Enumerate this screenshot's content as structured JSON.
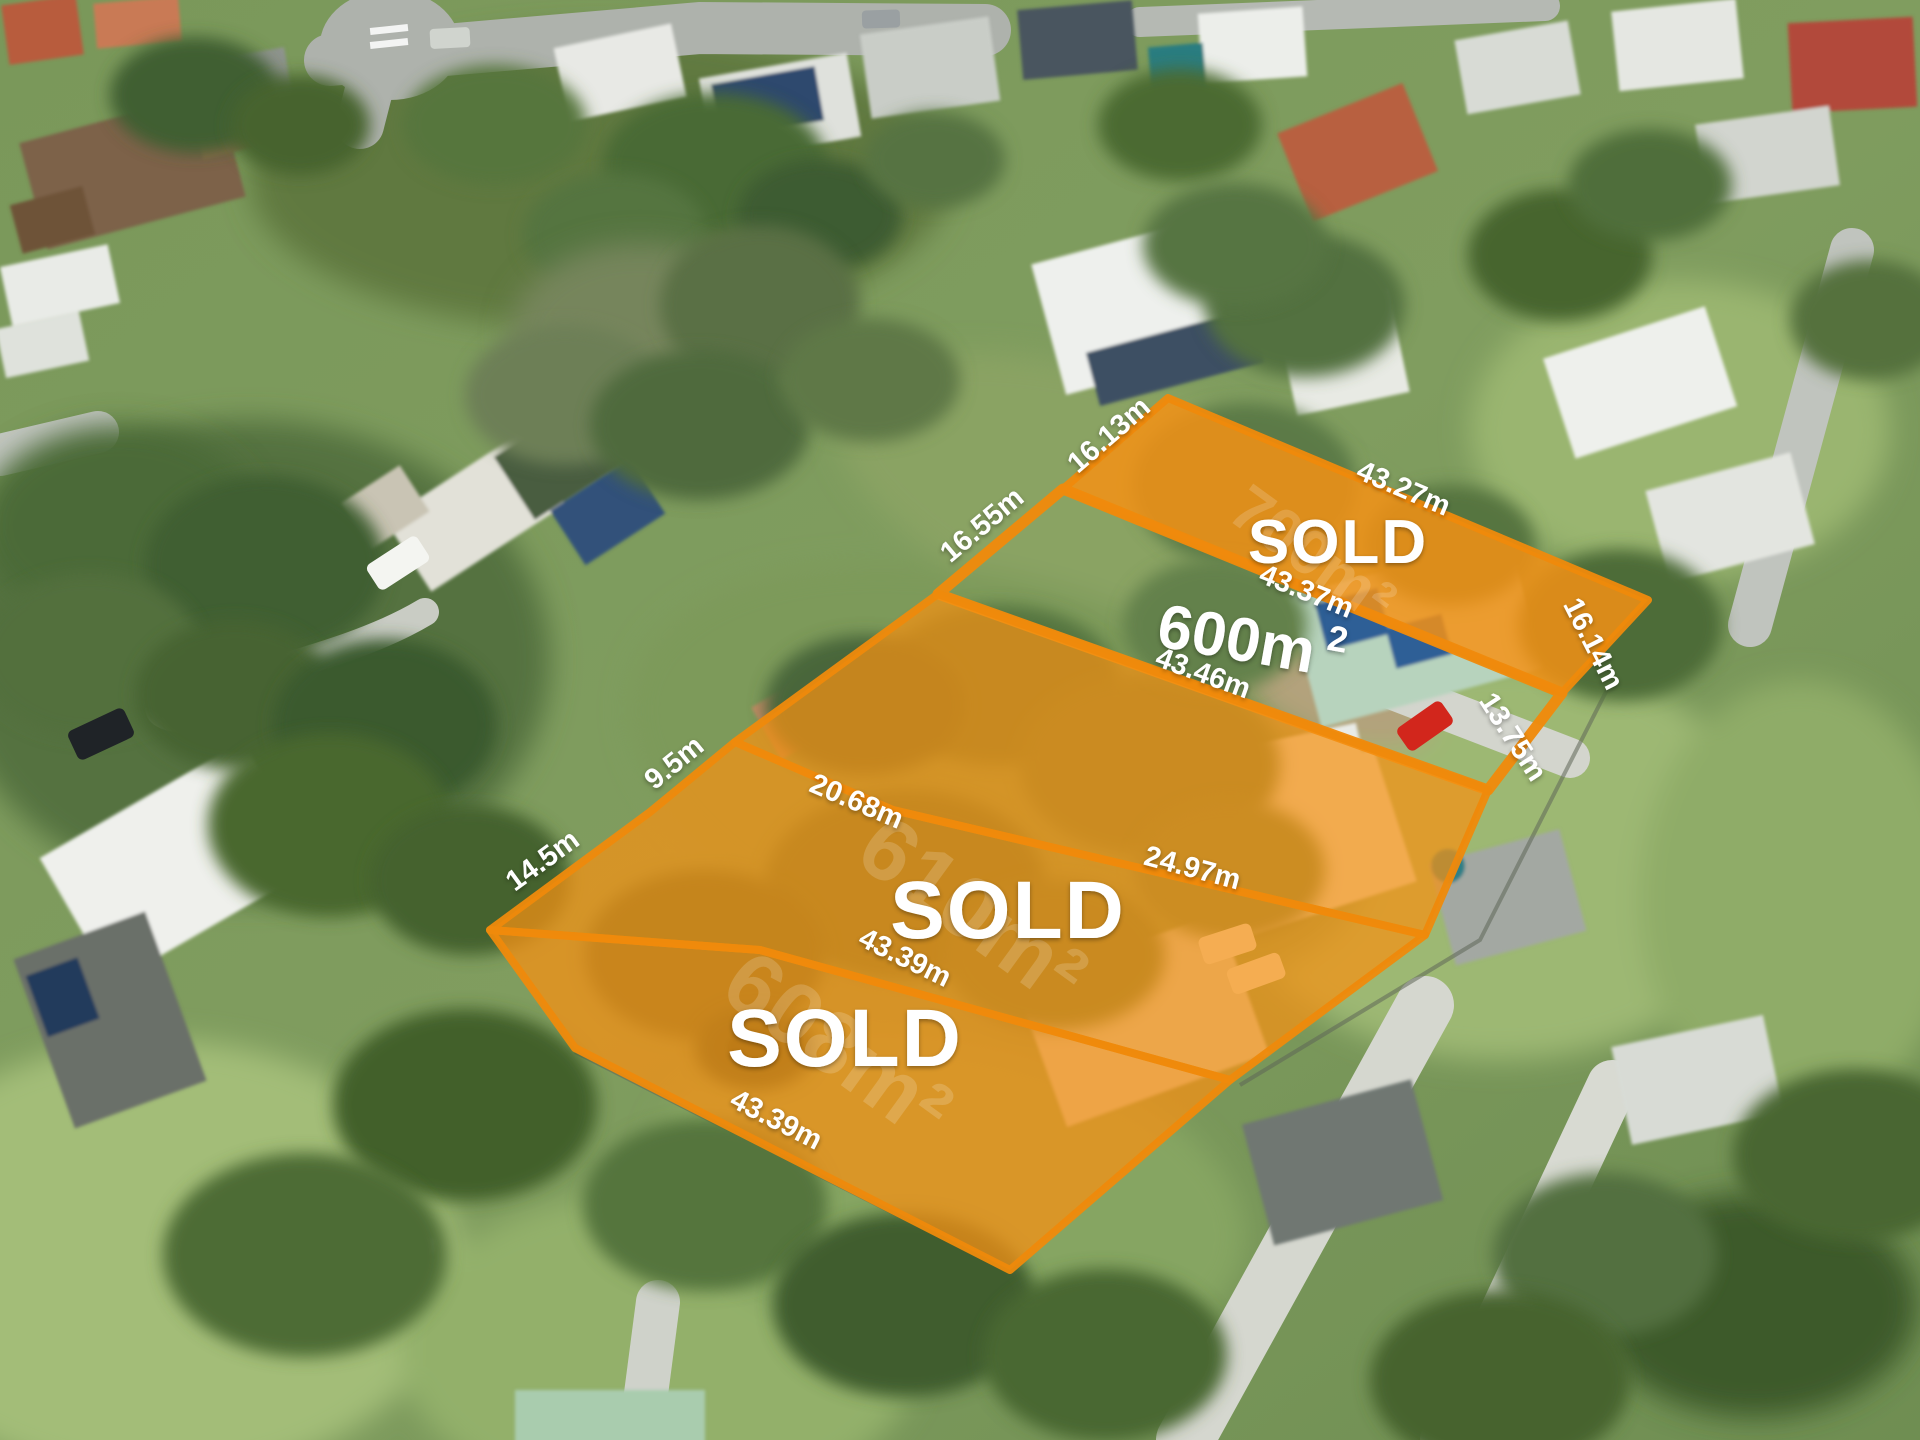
{
  "overlay": {
    "accent_color": "#EF8A0C",
    "label_color": "#FFFFFF",
    "lots": [
      {
        "id": "lot-top",
        "status_label": "SOLD",
        "area_watermark": "700m²"
      },
      {
        "id": "lot-for-sale",
        "area_value": "600m",
        "area_sup": "2"
      },
      {
        "id": "lot-middle",
        "status_label": "SOLD",
        "area_watermark": "610m²"
      },
      {
        "id": "lot-bottom",
        "status_label": "SOLD",
        "area_watermark": "608m²"
      }
    ],
    "measurements": [
      "16.13m",
      "43.27m",
      "16.55m",
      "43.37m",
      "43.46m",
      "16.14m",
      "13.75m",
      "9.5m",
      "20.68m",
      "24.97m",
      "43.39m",
      "14.5m",
      "43.39m"
    ]
  }
}
